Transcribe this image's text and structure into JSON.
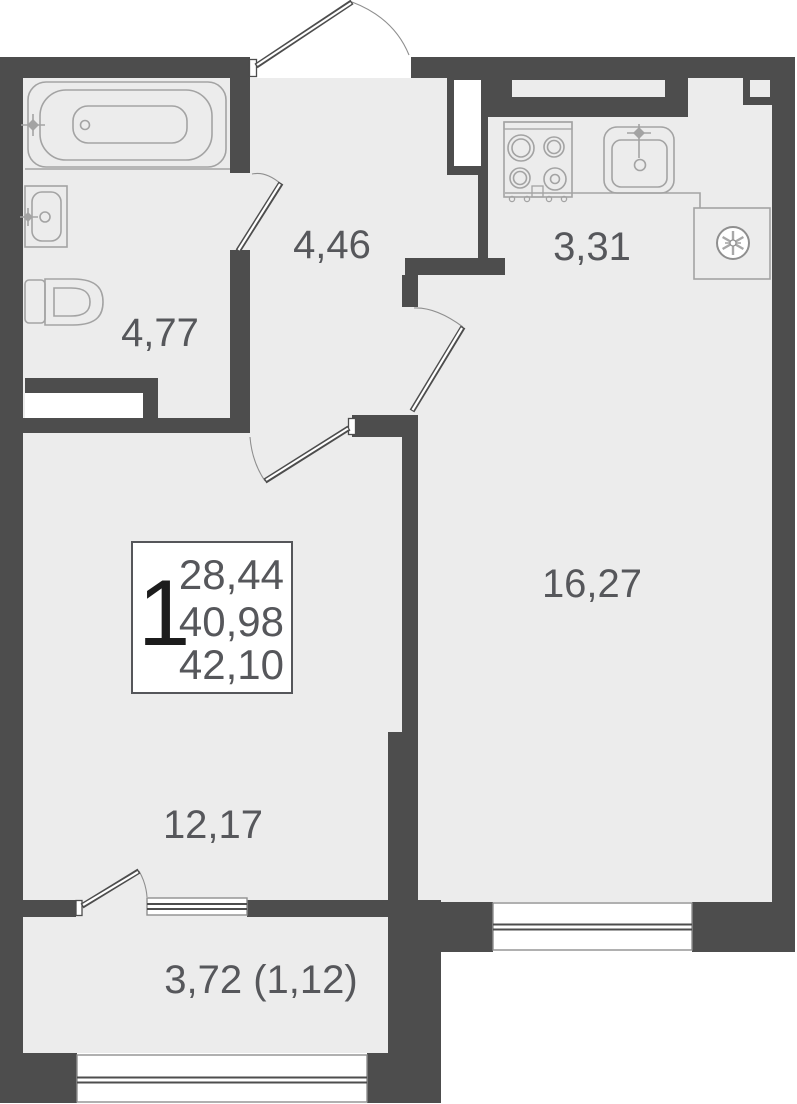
{
  "plan": {
    "type": "apartment-floor-plan",
    "legend": {
      "rooms_count": "1",
      "living_area": "28,44",
      "apartment_area": "40,98",
      "total_area": "42,10"
    },
    "rooms": {
      "hallway": "4,46",
      "bathroom": "4,77",
      "kitchen": "3,31",
      "living_room": "16,27",
      "bedroom": "12,17",
      "balcony": "3,72 (1,12)"
    },
    "fixtures": [
      "bathtub",
      "bathroom-sink",
      "toilet",
      "stove",
      "kitchen-sink",
      "ventilation-fan"
    ],
    "colors": {
      "wall": "#4d4d4d",
      "floor": "#ececec",
      "fixture_outline": "#a3a3a3",
      "label_text": "#56575b",
      "legend_number": "#1c1c1c",
      "background": "#ffffff"
    }
  }
}
